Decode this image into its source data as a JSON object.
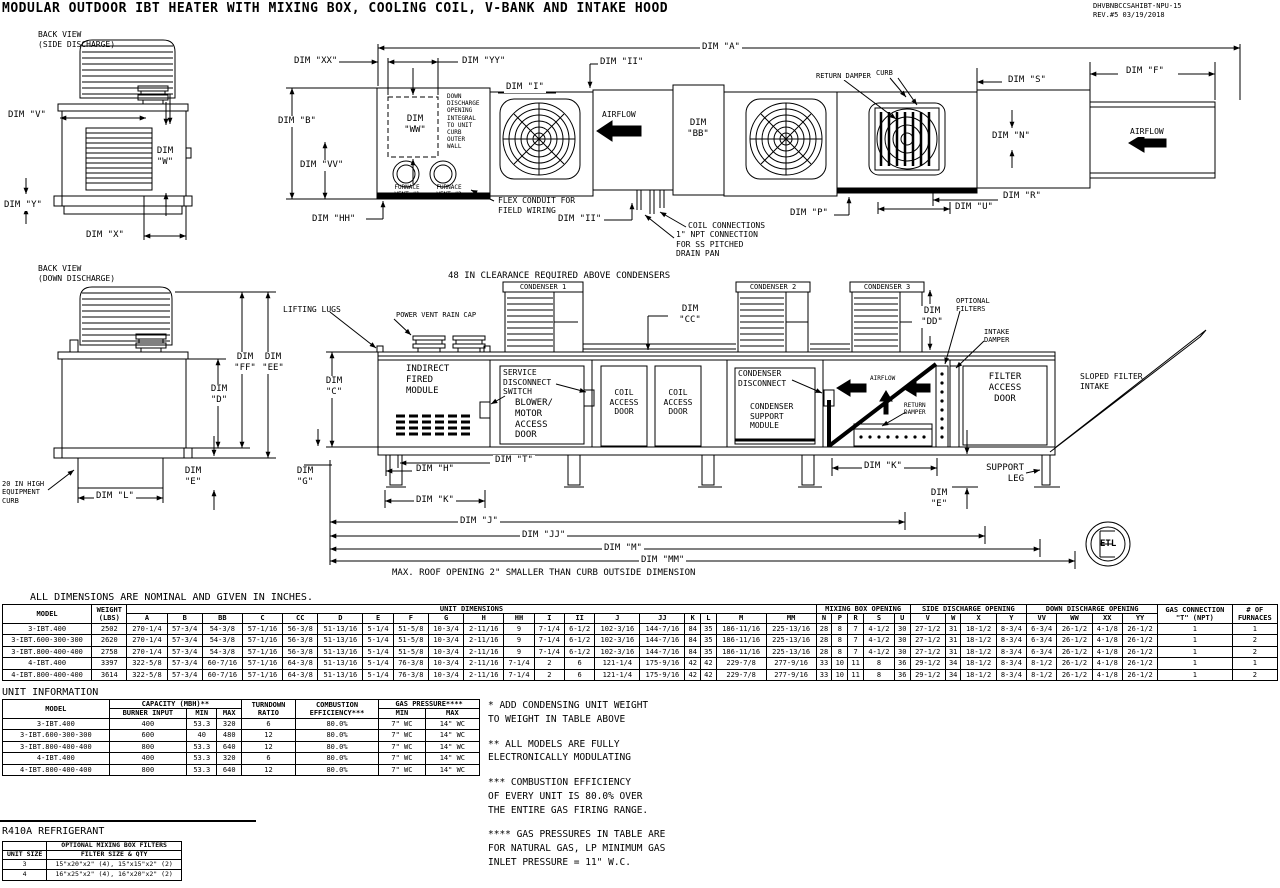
{
  "header": {
    "title": "MODULAR OUTDOOR IBT HEATER WITH MIXING BOX, COOLING COIL, V-BANK AND INTAKE HOOD",
    "doc_number": "DHVBNBCCSAHIBT-NPU-15",
    "revision": "REV.#5   03/19/2018"
  },
  "colors": {
    "ink": "#000000",
    "paper": "#ffffff"
  },
  "views": {
    "back_side_title": "BACK VIEW\n(SIDE DISCHARGE)",
    "back_down_title": "BACK VIEW\n(DOWN DISCHARGE)"
  },
  "dims": {
    "a": "DIM \"A\"",
    "b": "DIM \"B\"",
    "bb": "DIM\n\"BB\"",
    "c": "DIM\n\"C\"",
    "cc": "DIM\n\"CC\"",
    "d": "DIM\n\"D\"",
    "dd": "DIM\n\"DD\"",
    "e": "DIM\n\"E\"",
    "ee": "DIM\n\"EE\"",
    "f": "DIM \"F\"",
    "ff": "DIM\n\"FF\"",
    "g": "DIM\n\"G\"",
    "h": "DIM \"H\"",
    "hh": "DIM \"HH\"",
    "i": "DIM \"I\"",
    "ii": "DIM \"II\"",
    "j": "DIM \"J\"",
    "jj": "DIM \"JJ\"",
    "k": "DIM \"K\"",
    "l": "DIM \"L\"",
    "m": "DIM \"M\"",
    "mm": "DIM \"MM\"",
    "n": "DIM \"N\"",
    "p": "DIM \"P\"",
    "r": "DIM \"R\"",
    "s": "DIM \"S\"",
    "t": "DIM \"T\"",
    "u": "DIM \"U\"",
    "v": "DIM \"V\"",
    "vv": "DIM \"VV\"",
    "w": "DIM\n\"W\"",
    "ww": "DIM\n\"WW\"",
    "x": "DIM \"X\"",
    "xx": "DIM \"XX\"",
    "y": "DIM \"Y\"",
    "yy": "DIM \"YY\""
  },
  "labels": {
    "airflow": "AIRFLOW",
    "down_discharge_note": "DOWN\nDISCHARGE\nOPENING\nINTEGRAL\nTO UNIT\nCURB\nOUTER\nWALL",
    "furnace_vent_1": "FURNACE\nVENT #1",
    "furnace_vent_2": "FURNACE\nVENT #2",
    "flex_conduit": "FLEX CONDUIT FOR\nFIELD WIRING",
    "coil_connections": "COIL CONNECTIONS",
    "npt_note": "1\" NPT CONNECTION\nFOR SS PITCHED\nDRAIN PAN",
    "return_damper": "RETURN DAMPER",
    "curb": "CURB",
    "curb_20": "20 IN HIGH\nEQUIPMENT\nCURB",
    "clearance_note": "48 IN CLEARANCE REQUIRED ABOVE CONDENSERS",
    "condenser_1": "CONDENSER 1",
    "condenser_2": "CONDENSER 2",
    "condenser_3": "CONDENSER 3",
    "lifting_lugs": "LIFTING LUGS",
    "power_vent_rain_cap": "POWER VENT RAIN CAP",
    "indirect_fired": "INDIRECT\nFIRED\nMODULE",
    "service_disconnect": "SERVICE\nDISCONNECT\nSWITCH",
    "blower_door": "BLOWER/\nMOTOR\nACCESS\nDOOR",
    "coil_access_door": "COIL\nACCESS\nDOOR",
    "condenser_disconnect": "CONDENSER\nDISCONNECT",
    "condenser_support": "CONDENSER\nSUPPORT\nMODULE",
    "return_damper_2": "RETURN\nDAMPER",
    "optional_filters": "OPTIONAL\nFILTERS",
    "intake_damper": "INTAKE\nDAMPER",
    "filter_access_door": "FILTER\nACCESS\nDOOR",
    "sloped_filter_intake": "SLOPED FILTER\nINTAKE",
    "support_leg": "SUPPORT\nLEG",
    "roof_note": "MAX. ROOF OPENING 2\" SMALLER THAN CURB OUTSIDE DIMENSION",
    "etl": "ETL",
    "refrigerant": "R410A REFRIGERANT"
  },
  "dim_table": {
    "caption": "ALL DIMENSIONS ARE NOMINAL AND GIVEN IN INCHES.",
    "head": [
      [
        {
          "label": "MODEL",
          "rowspan": 2
        },
        {
          "label": "WEIGHT\n(LBS)",
          "rowspan": 2
        },
        {
          "label": "UNIT DIMENSIONS",
          "colspan": 19
        },
        {
          "label": "MIXING BOX OPENING",
          "colspan": 5
        },
        {
          "label": "SIDE DISCHARGE OPENING",
          "colspan": 4
        },
        {
          "label": "DOWN DISCHARGE OPENING",
          "colspan": 4
        },
        {
          "label": "GAS CONNECTION\n\"T\" (NPT)",
          "rowspan": 2
        },
        {
          "label": "# OF\nFURNACES",
          "rowspan": 2
        }
      ],
      [
        "A",
        "B",
        "BB",
        "C",
        "CC",
        "D",
        "E",
        "F",
        "G",
        "H",
        "HH",
        "I",
        "II",
        "J",
        "JJ",
        "K",
        "L",
        "M",
        "MM",
        "N",
        "P",
        "R",
        "S",
        "U",
        "V",
        "W",
        "X",
        "Y",
        "VV",
        "WW",
        "XX",
        "YY"
      ]
    ],
    "rows": [
      [
        "3-IBT.400",
        "2502",
        "270-1/4",
        "57-3/4",
        "54-3/8",
        "57-1/16",
        "56-3/8",
        "51-13/16",
        "5-1/4",
        "51-5/8",
        "10-3/4",
        "2-11/16",
        "9",
        "7-1/4",
        "6-1/2",
        "102-3/16",
        "144-7/16",
        "84",
        "35",
        "186-11/16",
        "225-13/16",
        "28",
        "8",
        "7",
        "4-1/2",
        "30",
        "27-1/2",
        "31",
        "18-1/2",
        "8-3/4",
        "6-3/4",
        "26-1/2",
        "4-1/8",
        "26-1/2",
        "1",
        "1"
      ],
      [
        "3-IBT.600-300-300",
        "2620",
        "270-1/4",
        "57-3/4",
        "54-3/8",
        "57-1/16",
        "56-3/8",
        "51-13/16",
        "5-1/4",
        "51-5/8",
        "10-3/4",
        "2-11/16",
        "9",
        "7-1/4",
        "6-1/2",
        "102-3/16",
        "144-7/16",
        "84",
        "35",
        "186-11/16",
        "225-13/16",
        "28",
        "8",
        "7",
        "4-1/2",
        "30",
        "27-1/2",
        "31",
        "18-1/2",
        "8-3/4",
        "6-3/4",
        "26-1/2",
        "4-1/8",
        "26-1/2",
        "1",
        "2"
      ],
      [
        "3-IBT.800-400-400",
        "2758",
        "270-1/4",
        "57-3/4",
        "54-3/8",
        "57-1/16",
        "56-3/8",
        "51-13/16",
        "5-1/4",
        "51-5/8",
        "10-3/4",
        "2-11/16",
        "9",
        "7-1/4",
        "6-1/2",
        "102-3/16",
        "144-7/16",
        "84",
        "35",
        "186-11/16",
        "225-13/16",
        "28",
        "8",
        "7",
        "4-1/2",
        "30",
        "27-1/2",
        "31",
        "18-1/2",
        "8-3/4",
        "6-3/4",
        "26-1/2",
        "4-1/8",
        "26-1/2",
        "1",
        "2"
      ],
      [
        "4-IBT.400",
        "3397",
        "322-5/8",
        "57-3/4",
        "60-7/16",
        "57-1/16",
        "64-3/8",
        "51-13/16",
        "5-1/4",
        "76-3/8",
        "10-3/4",
        "2-11/16",
        "7-1/4",
        "2",
        "6",
        "121-1/4",
        "175-9/16",
        "42",
        "42",
        "229-7/8",
        "277-9/16",
        "33",
        "10",
        "11",
        "8",
        "36",
        "29-1/2",
        "34",
        "18-1/2",
        "8-3/4",
        "8-1/2",
        "26-1/2",
        "4-1/8",
        "26-1/2",
        "1",
        "1"
      ],
      [
        "4-IBT.800-400-400",
        "3614",
        "322-5/8",
        "57-3/4",
        "60-7/16",
        "57-1/16",
        "64-3/8",
        "51-13/16",
        "5-1/4",
        "76-3/8",
        "10-3/4",
        "2-11/16",
        "7-1/4",
        "2",
        "6",
        "121-1/4",
        "175-9/16",
        "42",
        "42",
        "229-7/8",
        "277-9/16",
        "33",
        "10",
        "11",
        "8",
        "36",
        "29-1/2",
        "34",
        "18-1/2",
        "8-3/4",
        "8-1/2",
        "26-1/2",
        "4-1/8",
        "26-1/2",
        "1",
        "2"
      ]
    ]
  },
  "unit_info": {
    "title": "UNIT INFORMATION",
    "head": [
      [
        {
          "label": "MODEL",
          "rowspan": 2
        },
        {
          "label": "CAPACITY (MBH)**",
          "colspan": 3
        },
        {
          "label": "TURNDOWN\nRATIO",
          "rowspan": 2
        },
        {
          "label": "COMBUSTION\nEFFICIENCY***",
          "rowspan": 2
        },
        {
          "label": "GAS PRESSURE****",
          "colspan": 2
        }
      ],
      [
        "BURNER INPUT",
        "MIN",
        "MAX",
        "MIN",
        "MAX"
      ]
    ],
    "rows": [
      [
        "3-IBT.400",
        "400",
        "53.3",
        "320",
        "6",
        "80.0%",
        "7\" WC",
        "14\" WC"
      ],
      [
        "3-IBT.600-300-300",
        "600",
        "40",
        "480",
        "12",
        "80.0%",
        "7\" WC",
        "14\" WC"
      ],
      [
        "3-IBT.800-400-400",
        "800",
        "53.3",
        "640",
        "12",
        "80.0%",
        "7\" WC",
        "14\" WC"
      ],
      [
        "4-IBT.400",
        "400",
        "53.3",
        "320",
        "6",
        "80.0%",
        "7\" WC",
        "14\" WC"
      ],
      [
        "4-IBT.800-400-400",
        "800",
        "53.3",
        "640",
        "12",
        "80.0%",
        "7\" WC",
        "14\" WC"
      ]
    ]
  },
  "notes": {
    "n1": "* ADD CONDENSING UNIT WEIGHT\nTO WEIGHT IN TABLE ABOVE",
    "n2": "** ALL MODELS ARE FULLY\n ELECTRONICALLY MODULATING",
    "n3": "*** COMBUSTION EFFICIENCY\nOF EVERY UNIT IS 80.0% OVER\nTHE ENTIRE GAS FIRING RANGE.",
    "n4": "**** GAS PRESSURES IN TABLE ARE\nFOR NATURAL GAS,  LP MINIMUM GAS\nINLET PRESSURE = 11\" W.C."
  },
  "filters_table": {
    "head": [
      [
        {
          "label": ""
        },
        {
          "label": "OPTIONAL MIXING BOX FILTERS"
        }
      ],
      [
        {
          "label": "UNIT SIZE"
        },
        {
          "label": "FILTER SIZE & QTY"
        }
      ]
    ],
    "rows": [
      [
        "3",
        "15\"x20\"x2\" (4), 15\"x15\"x2\" (2)"
      ],
      [
        "4",
        "16\"x25\"x2\" (4), 16\"x20\"x2\" (2)"
      ]
    ]
  }
}
